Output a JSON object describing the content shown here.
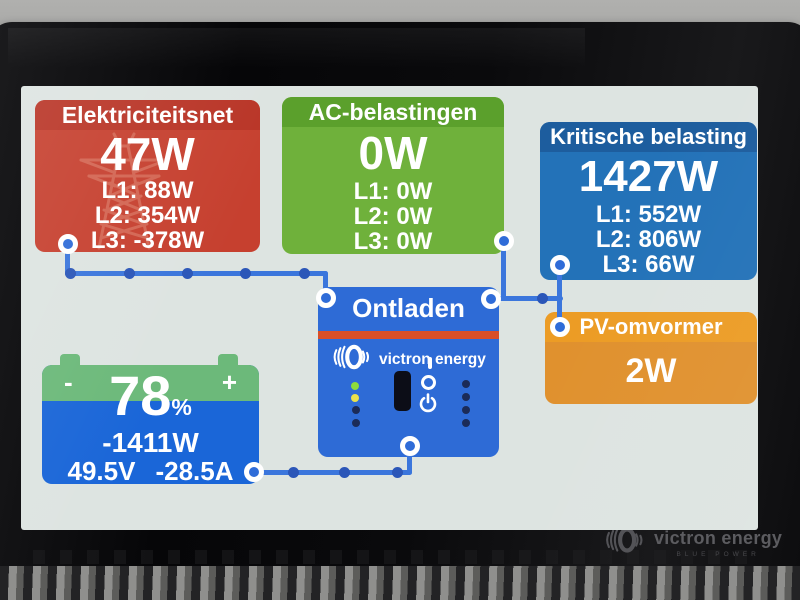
{
  "brand": {
    "name": "victron energy",
    "tagline": "BLUE POWER"
  },
  "screen": {
    "grid_panel": {
      "title": "Elektriciteitsnet",
      "value": "47W",
      "lines": [
        "L1: 88W",
        "L2: 354W",
        "L3: -378W"
      ]
    },
    "ac_loads_panel": {
      "title": "AC-belastingen",
      "value": "0W",
      "lines": [
        "L1: 0W",
        "L2: 0W",
        "L3: 0W"
      ]
    },
    "critical_loads_panel": {
      "title": "Kritische belasting",
      "value": "1427W",
      "lines": [
        "L1: 552W",
        "L2: 806W",
        "L3: 66W"
      ]
    },
    "inverter_panel": {
      "title": "Ontladen",
      "brand": "victron energy",
      "switch_on_label": "I"
    },
    "pv_panel": {
      "title": "PV-omvormer",
      "value": "2W"
    },
    "battery_panel": {
      "minus": "-",
      "plus": "+",
      "soc": "78",
      "soc_unit": "%",
      "power": "-1411W",
      "voltage": "49.5V",
      "current": "-28.5A"
    }
  },
  "colors": {
    "wire_blue": "#3b76dc",
    "grid_red": "#c6402f",
    "ac_loads_green": "#6fb13b",
    "critical_blue": "#2372b8",
    "pv_orange": "#e0912e",
    "inverter_blue": "#2e6bd6",
    "battery_blue": "#1a66d8",
    "battery_band_green": "#6cb97a",
    "led_green": "#8edc3c",
    "led_yellow": "#eae14c",
    "led_off": "#1b2b58"
  }
}
